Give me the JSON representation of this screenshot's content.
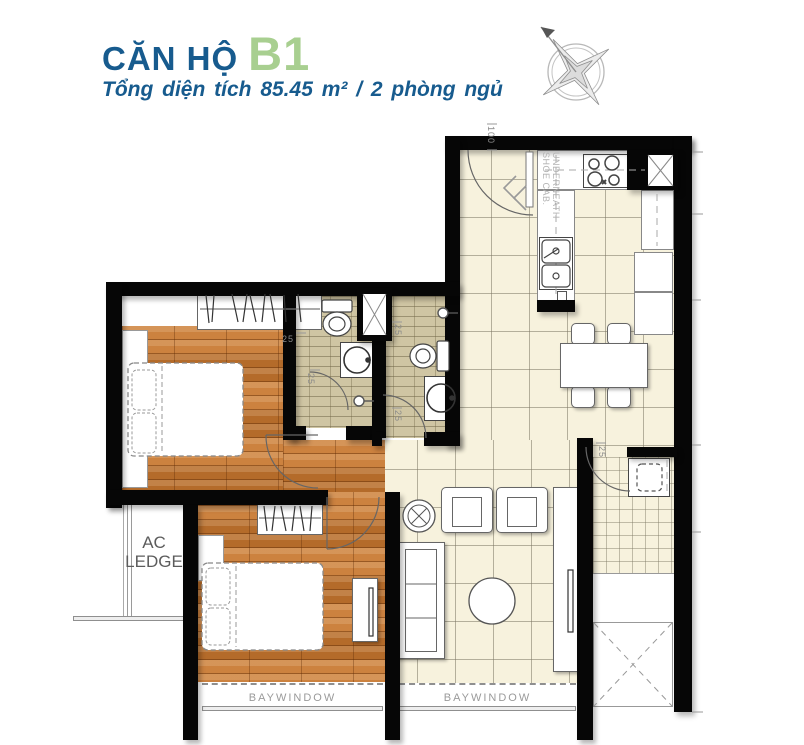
{
  "header": {
    "title_prefix": "CĂN HỘ",
    "unit_code": "B1",
    "subtitle": "Tổng diện tích 85.45 m²  /  2 phòng ngủ"
  },
  "floorplan": {
    "labels": {
      "shoe_cabinet": "SHOE CAB. UNDERNEATH",
      "ac_ledge": "AC LEDGE",
      "baywindow": "BAYWINDOW"
    },
    "dimensions": {
      "entrance_width": "100",
      "offsets": [
        "25",
        "25",
        "25",
        "25",
        "25"
      ]
    },
    "colors": {
      "title_blue": "#175b8e",
      "unit_green": "#a8cf90",
      "wall_black": "#060606",
      "wood_floor": "#c8772f",
      "tile_floor": "#f7f2dd",
      "bath_tile": "#cfc5a3"
    }
  }
}
